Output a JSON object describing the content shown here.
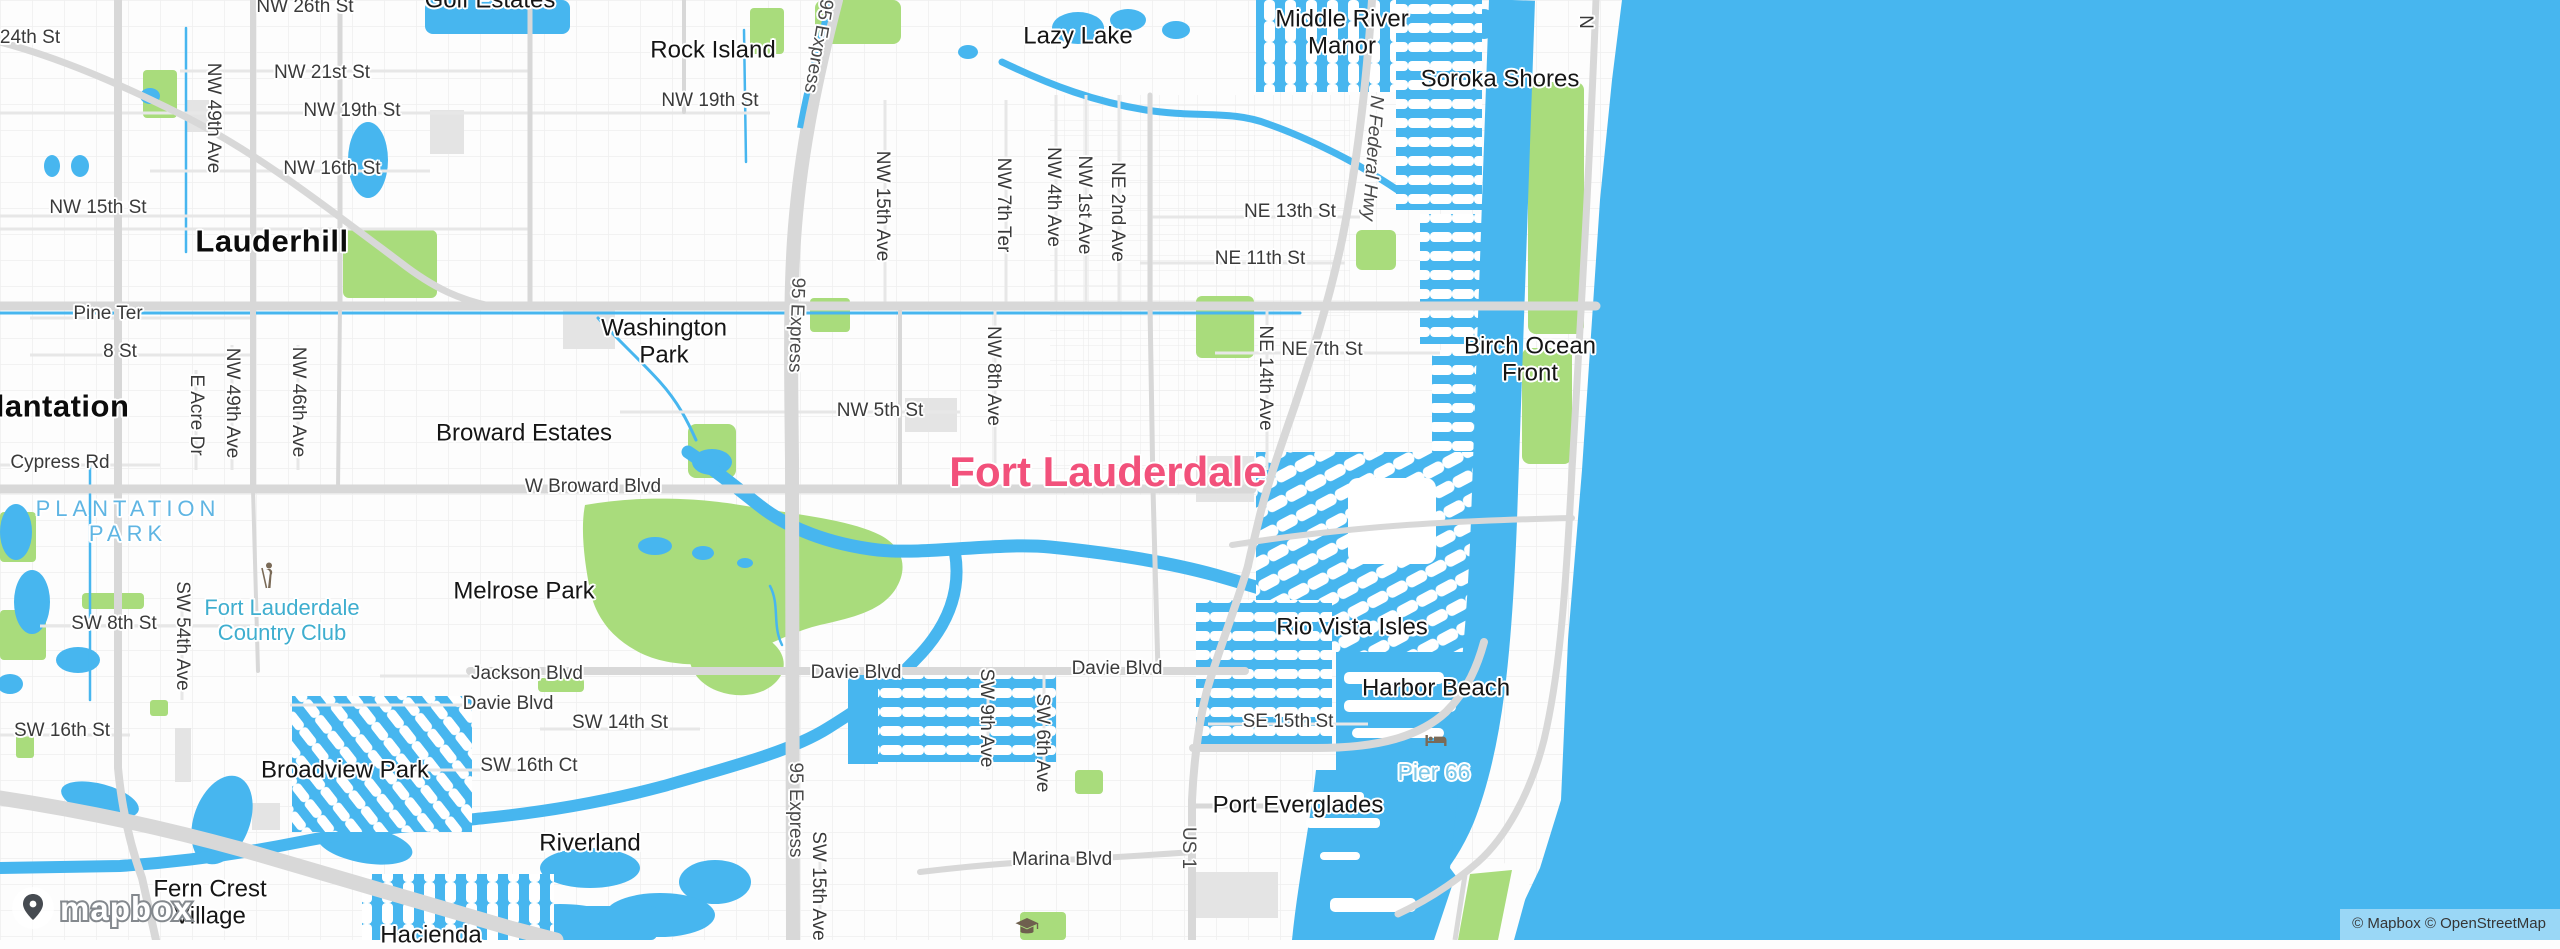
{
  "map": {
    "attribution": "© Mapbox © OpenStreetMap",
    "logo_text": "mapbox",
    "colors": {
      "water": "#47B6EF",
      "park": "#A9DC7C",
      "road_major": "#D8D8D8",
      "road_minor": "#E9E9E9",
      "city_highlight": "#F2517B",
      "park_label": "#5FB5E3",
      "golf_label": "#3FAECF",
      "water_poi_label": "#7EC8E8",
      "poi_icon_brown": "#7A6A57"
    },
    "labels": [
      {
        "text": "Lauderhill",
        "x": 272,
        "y": 241,
        "type": "city",
        "rot": 0
      },
      {
        "text": "Plantation",
        "x": 52,
        "y": 406,
        "type": "city",
        "rot": 0
      },
      {
        "text": "Fort Lauderdale",
        "x": 1108,
        "y": 472,
        "type": "place",
        "rot": 0
      },
      {
        "text": "Rock Island",
        "x": 713,
        "y": 50,
        "type": "nbhd",
        "rot": 0
      },
      {
        "text": "Lazy Lake",
        "x": 1078,
        "y": 36,
        "type": "nbhd",
        "rot": 0
      },
      {
        "text": "Middle River\nManor",
        "x": 1342,
        "y": 33,
        "type": "nbhd",
        "rot": 0
      },
      {
        "text": "Soroka Shores",
        "x": 1500,
        "y": 79,
        "type": "nbhd",
        "rot": 0
      },
      {
        "text": "Golf Estates",
        "x": 490,
        "y": 0,
        "type": "nbhd",
        "rot": 0
      },
      {
        "text": "Washington\nPark",
        "x": 664,
        "y": 342,
        "type": "nbhd",
        "rot": 0
      },
      {
        "text": "Broward Estates",
        "x": 524,
        "y": 433,
        "type": "nbhd",
        "rot": 0
      },
      {
        "text": "Birch Ocean\nFront",
        "x": 1530,
        "y": 360,
        "type": "nbhd",
        "rot": 0
      },
      {
        "text": "Melrose Park",
        "x": 524,
        "y": 591,
        "type": "nbhd",
        "rot": 0
      },
      {
        "text": "Rio Vista Isles",
        "x": 1352,
        "y": 627,
        "type": "nbhd",
        "rot": 0
      },
      {
        "text": "Harbor Beach",
        "x": 1436,
        "y": 688,
        "type": "nbhd",
        "rot": 0
      },
      {
        "text": "Broadview Park",
        "x": 345,
        "y": 770,
        "type": "nbhd",
        "rot": 0
      },
      {
        "text": "Riverland",
        "x": 590,
        "y": 843,
        "type": "nbhd",
        "rot": 0
      },
      {
        "text": "Fern Crest\nVillage",
        "x": 210,
        "y": 903,
        "type": "nbhd",
        "rot": 0
      },
      {
        "text": "Hacienda",
        "x": 431,
        "y": 935,
        "type": "nbhd",
        "rot": 0
      },
      {
        "text": "Port Everglades",
        "x": 1298,
        "y": 805,
        "type": "nbhd",
        "rot": 0
      },
      {
        "text": "24th St",
        "x": 30,
        "y": 38,
        "type": "street",
        "rot": 0
      },
      {
        "text": "NW 26th St",
        "x": 305,
        "y": 7,
        "type": "street",
        "rot": 0
      },
      {
        "text": "NW 21st St",
        "x": 322,
        "y": 73,
        "type": "street",
        "rot": 0
      },
      {
        "text": "NW 19th St",
        "x": 352,
        "y": 111,
        "type": "street",
        "rot": 0
      },
      {
        "text": "NW 19th St",
        "x": 710,
        "y": 101,
        "type": "street",
        "rot": 0
      },
      {
        "text": "NW 16th St",
        "x": 332,
        "y": 169,
        "type": "street",
        "rot": 0
      },
      {
        "text": "NW 15th St",
        "x": 98,
        "y": 208,
        "type": "street",
        "rot": 0
      },
      {
        "text": "Pine Ter",
        "x": 108,
        "y": 314,
        "type": "street",
        "rot": 0
      },
      {
        "text": "8 St",
        "x": 120,
        "y": 352,
        "type": "street",
        "rot": 0
      },
      {
        "text": "Cypress Rd",
        "x": 60,
        "y": 463,
        "type": "street",
        "rot": 0
      },
      {
        "text": "NW 5th St",
        "x": 880,
        "y": 411,
        "type": "street",
        "rot": 0
      },
      {
        "text": "NE 13th St",
        "x": 1290,
        "y": 212,
        "type": "street",
        "rot": 0
      },
      {
        "text": "NE 11th St",
        "x": 1260,
        "y": 259,
        "type": "street",
        "rot": 0
      },
      {
        "text": "NE 7th St",
        "x": 1322,
        "y": 350,
        "type": "street",
        "rot": 0
      },
      {
        "text": "W Broward Blvd",
        "x": 593,
        "y": 487,
        "type": "street",
        "rot": 0
      },
      {
        "text": "SW 8th St",
        "x": 114,
        "y": 624,
        "type": "street",
        "rot": 0
      },
      {
        "text": "Jackson Blvd",
        "x": 527,
        "y": 674,
        "type": "street",
        "rot": 0
      },
      {
        "text": "Davie Blvd",
        "x": 508,
        "y": 704,
        "type": "street",
        "rot": 0
      },
      {
        "text": "Davie Blvd",
        "x": 856,
        "y": 673,
        "type": "street",
        "rot": 0
      },
      {
        "text": "Davie Blvd",
        "x": 1117,
        "y": 669,
        "type": "street",
        "rot": 0
      },
      {
        "text": "SW 14th St",
        "x": 620,
        "y": 723,
        "type": "street",
        "rot": 0
      },
      {
        "text": "SW 16th St",
        "x": 62,
        "y": 731,
        "type": "street",
        "rot": 0
      },
      {
        "text": "SW 16th Ct",
        "x": 529,
        "y": 766,
        "type": "street",
        "rot": 0
      },
      {
        "text": "SE 15th St",
        "x": 1288,
        "y": 722,
        "type": "street",
        "rot": 0
      },
      {
        "text": "Marina Blvd",
        "x": 1062,
        "y": 860,
        "type": "street",
        "rot": 0
      },
      {
        "text": "NW 49th Ave",
        "x": 213,
        "y": 118,
        "type": "streetv",
        "rot": 90
      },
      {
        "text": "NW 49th Ave",
        "x": 232,
        "y": 403,
        "type": "streetv",
        "rot": 90
      },
      {
        "text": "NW 46th Ave",
        "x": 298,
        "y": 402,
        "type": "streetv",
        "rot": 90
      },
      {
        "text": "E Acre Dr",
        "x": 196,
        "y": 415,
        "type": "streetv",
        "rot": 90
      },
      {
        "text": "SW 54th Ave",
        "x": 182,
        "y": 636,
        "type": "streetv",
        "rot": 90
      },
      {
        "text": "NW 15th Ave",
        "x": 882,
        "y": 206,
        "type": "streetv",
        "rot": 90
      },
      {
        "text": "NW 7th Ter",
        "x": 1003,
        "y": 205,
        "type": "streetv",
        "rot": 90
      },
      {
        "text": "NW 4th Ave",
        "x": 1053,
        "y": 197,
        "type": "streetv",
        "rot": 90
      },
      {
        "text": "NW 1st Ave",
        "x": 1084,
        "y": 205,
        "type": "streetv",
        "rot": 90
      },
      {
        "text": "NE 2nd Ave",
        "x": 1117,
        "y": 212,
        "type": "streetv",
        "rot": 90
      },
      {
        "text": "NW 8th Ave",
        "x": 993,
        "y": 376,
        "type": "streetv",
        "rot": 90
      },
      {
        "text": "NE 14th Ave",
        "x": 1265,
        "y": 378,
        "type": "streetv",
        "rot": 90
      },
      {
        "text": "SW 9th Ave",
        "x": 986,
        "y": 718,
        "type": "streetv",
        "rot": 90
      },
      {
        "text": "SW 6th Ave",
        "x": 1042,
        "y": 743,
        "type": "streetv",
        "rot": 90
      },
      {
        "text": "SW 15th Ave",
        "x": 818,
        "y": 886,
        "type": "streetv",
        "rot": 90
      },
      {
        "text": "N",
        "x": 1585,
        "y": 22,
        "type": "streetv",
        "rot": 90
      },
      {
        "text": "95 Express",
        "x": 818,
        "y": 46,
        "type": "hwy",
        "rot": 100
      },
      {
        "text": "95 Express",
        "x": 796,
        "y": 325,
        "type": "hwy",
        "rot": 92
      },
      {
        "text": "95 Express",
        "x": 795,
        "y": 810,
        "type": "hwy",
        "rot": 90
      },
      {
        "text": "N Federal Hwy",
        "x": 1372,
        "y": 158,
        "type": "hwyi",
        "rot": 94
      },
      {
        "text": "US 1",
        "x": 1188,
        "y": 848,
        "type": "hwy",
        "rot": 90
      },
      {
        "text": "PLANTATION\nPARK",
        "x": 128,
        "y": 521,
        "type": "park2",
        "rot": 0
      },
      {
        "text": "Fort Lauderdale\nCountry Club",
        "x": 282,
        "y": 620,
        "type": "golf",
        "rot": 0
      },
      {
        "text": "Pier 66",
        "x": 1434,
        "y": 772,
        "type": "waterpoi",
        "rot": 0
      }
    ],
    "icons": [
      {
        "name": "golfer-icon",
        "x": 268,
        "y": 578
      },
      {
        "name": "lodging-icon",
        "x": 1436,
        "y": 745
      },
      {
        "name": "school-icon",
        "x": 1027,
        "y": 930
      }
    ]
  }
}
